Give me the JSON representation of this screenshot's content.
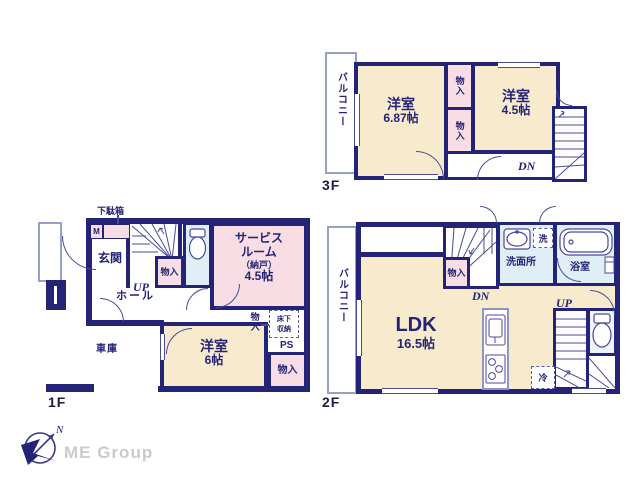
{
  "brand": {
    "name": "ME Group"
  },
  "compass": {
    "north": "N"
  },
  "colors": {
    "wall": "#232377",
    "room_fill": "#f8ebcd",
    "closet_fill": "#f8dde4",
    "wet_area_fill": "#e0eef6",
    "brand_gray": "#cbcbce"
  },
  "floor3": {
    "label": "3F",
    "balcony": "バルコニー",
    "room_a": {
      "name": "洋室",
      "size": "6.87帖"
    },
    "room_b": {
      "name": "洋室",
      "size": "4.5帖"
    },
    "closet_a": "物入",
    "closet_b": "物入",
    "stairs_down": "DN"
  },
  "floor2": {
    "label": "2F",
    "balcony": "バルコニー",
    "ldk": {
      "name": "LDK",
      "size": "16.5帖"
    },
    "closet": "物入",
    "stairs_down": "DN",
    "stairs_up": "UP",
    "washroom": "洗面所",
    "laundry": "洗",
    "bathroom": "浴室",
    "fridge": "冷"
  },
  "floor1": {
    "label": "1F",
    "shoe_cabinet": "下駄箱",
    "meter_box": "M",
    "entrance": "玄関",
    "stairs_up": "UP",
    "hall": "ホール",
    "stair_closet": "物入",
    "service_room": {
      "line1": "サービス",
      "line2": "ルーム",
      "line3": "（納戸）",
      "line4": "4.5帖"
    },
    "garage": "車庫",
    "room": {
      "name": "洋室",
      "size": "6帖"
    },
    "corner_closet_label": "物入",
    "underfloor_storage": {
      "line1": "床下",
      "line2": "収納"
    },
    "pipe_space": "PS",
    "closet": "物入"
  }
}
